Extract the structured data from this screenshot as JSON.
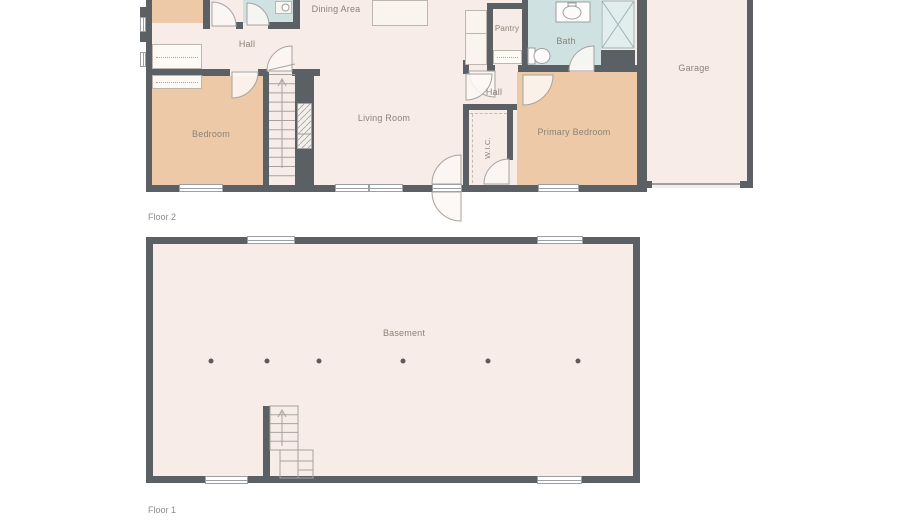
{
  "colors": {
    "background": "#ffffff",
    "wall": "#5b6065",
    "floor": "#f7ece7",
    "room_warm": "#edc9a8",
    "room_wet": "#cfe1e1",
    "label_text": "#8b8378",
    "caption_text": "#8c8c8c",
    "column_dot": "#5f5a5c",
    "closet_dash": "#c9998f"
  },
  "floor2": {
    "caption": "Floor 2",
    "rooms": {
      "dining_area": "Dining Area",
      "hall_top": "Hall",
      "pantry": "Pantry",
      "bath": "Bath",
      "garage": "Garage",
      "bedroom": "Bedroom",
      "living_room": "Living Room",
      "hall_inner": "Hall",
      "wic": "W.I.C.",
      "primary_bedroom": "Primary Bedroom"
    }
  },
  "floor1": {
    "caption": "Floor 1",
    "rooms": {
      "basement": "Basement"
    }
  }
}
